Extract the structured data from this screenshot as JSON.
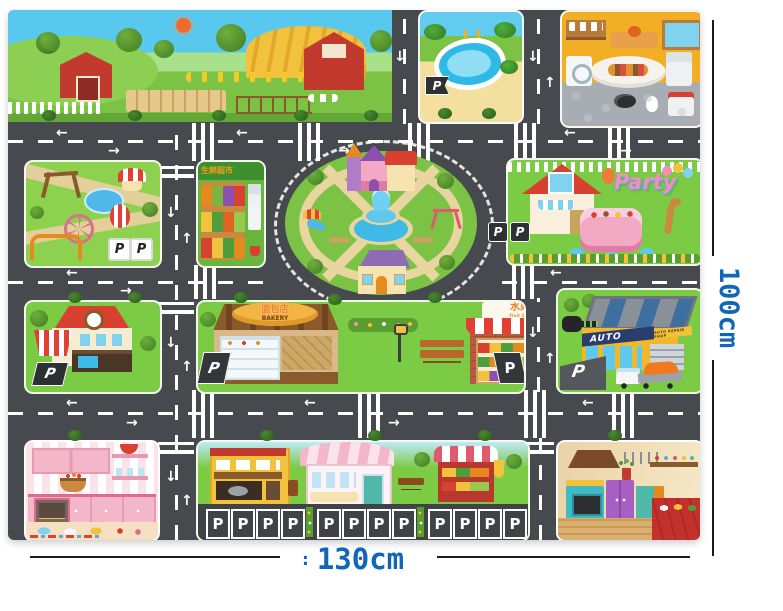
{
  "annotations": {
    "height_label": "100cm",
    "width_prefix": ": ",
    "width_label": "130cm",
    "label_color": "#1266b8"
  },
  "labels": {
    "p": "P",
    "party": "Party",
    "bakery_cn": "面包店",
    "bakery_en": "BAKERY",
    "fruit_market_cn": "水果超市",
    "fruit_market_en": "Fruit Supermarket",
    "fresh_market_cn": "生鲜超市",
    "auto": "AUTO",
    "auto_sub": "AUTO REPAIR SHOP"
  },
  "icons": {
    "arrow_left": "←",
    "arrow_right": "→",
    "arrow_up": "↑",
    "arrow_down": "↓"
  },
  "colors": {
    "road": "#46494d",
    "grass": "#76c63e",
    "sky": "#55c6ee",
    "dimension_text": "#1266b8",
    "mat_background": "#ffffff"
  }
}
